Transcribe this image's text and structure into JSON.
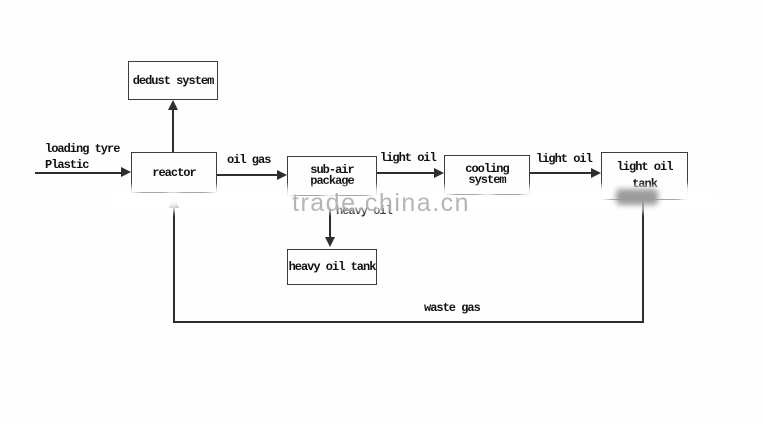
{
  "diagram": {
    "watermark": "trade.china.cn",
    "nodes": {
      "dedust_system": {
        "label": "dedust system"
      },
      "reactor": {
        "label": "reactor"
      },
      "sub_air_package": {
        "line1": "sub-air",
        "line2": "package"
      },
      "cooling_system": {
        "line1": "cooling",
        "line2": "system"
      },
      "light_oil_tank": {
        "line1": "light oil",
        "line2": "tank"
      },
      "heavy_oil_tank": {
        "label": "heavy oil tank"
      }
    },
    "flow_labels": {
      "feed_line1": "loading tyre",
      "feed_line2": "Plastic",
      "oil_gas": "oil gas",
      "light_oil_to_cooling": "light oil",
      "light_oil_to_tank": "light oil",
      "heavy_oil": "heavy oil",
      "waste_gas": "waste gas"
    },
    "colors": {
      "line": "#2e2e2e",
      "text": "#101010",
      "watermark": "#a9a9a9"
    }
  }
}
